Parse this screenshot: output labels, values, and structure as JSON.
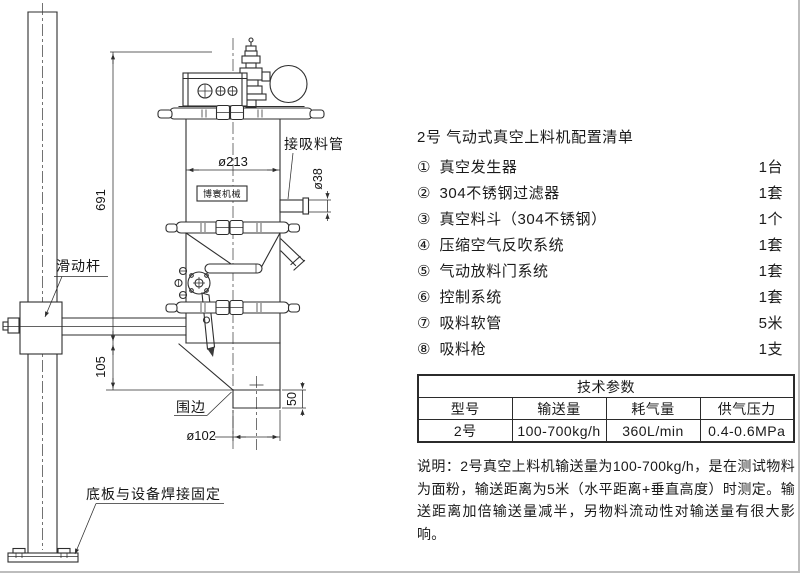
{
  "parts_list": {
    "title": "2号 气动式真空上料机配置清单",
    "items": [
      {
        "num": "①",
        "name": "真空发生器",
        "qty": "1台"
      },
      {
        "num": "②",
        "name": "304不锈钢过滤器",
        "qty": "1套"
      },
      {
        "num": "③",
        "name": "真空料斗（304不锈钢）",
        "qty": "1个"
      },
      {
        "num": "④",
        "name": "压缩空气反吹系统",
        "qty": "1套"
      },
      {
        "num": "⑤",
        "name": "气动放料门系统",
        "qty": "1套"
      },
      {
        "num": "⑥",
        "name": "控制系统",
        "qty": "1套"
      },
      {
        "num": "⑦",
        "name": "吸料软管",
        "qty": "5米"
      },
      {
        "num": "⑧",
        "name": "吸料枪",
        "qty": "1支"
      }
    ]
  },
  "spec_table": {
    "title": "技术参数",
    "columns": [
      "型号",
      "输送量",
      "耗气量",
      "供气压力"
    ],
    "rows": [
      [
        "2号",
        "100-700kg/h",
        "360L/min",
        "0.4-0.6MPa"
      ]
    ]
  },
  "notes": {
    "label": "说明：",
    "text": "2号真空上料机输送量为100-700kg/h，是在测试物料为面粉，输送距离为5米（水平距离+垂直高度）时测定。输送距离加倍输送量减半，另物料流动性对输送量有很大影响。"
  },
  "drawing": {
    "labels": {
      "dim_height": "691",
      "dim_lower": "105",
      "dim_body_dia": "ø213",
      "dim_inlet_dia": "ø38",
      "dim_outlet_dia": "ø102",
      "dim_outlet_h": "50",
      "slide_rod": "滑动杆",
      "skirt": "围边",
      "suction_pipe": "接吸料管",
      "base_plate": "底板与设备焊接固定",
      "brand": "博寰机械"
    }
  }
}
